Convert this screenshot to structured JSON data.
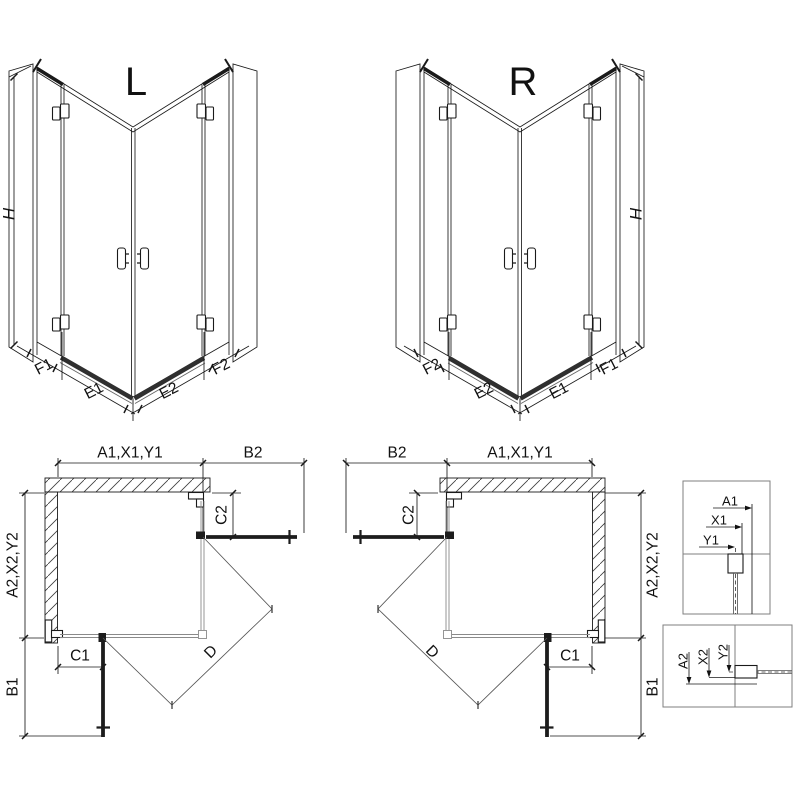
{
  "drawing": {
    "background": "#ffffff",
    "line_color": "#1a1a1a",
    "glass_color": "#8a8a8a",
    "door_color": "#1c1c1c"
  },
  "iso_left": {
    "title": "L",
    "height_dim": "H",
    "base_dims": [
      "F1",
      "E1",
      "E2",
      "F2"
    ]
  },
  "iso_right": {
    "title": "R",
    "height_dim": "H",
    "base_dims": [
      "F2",
      "E2",
      "E1",
      "F1"
    ]
  },
  "plan_left": {
    "width_dim": "A1,X1,Y1",
    "door_width_dim": "B2",
    "depth_dim": "A2,X2,Y2",
    "door_depth_dim": "B1",
    "fixed_bottom_dim": "C1",
    "fixed_side_dim": "C2",
    "entry_dim": "D"
  },
  "plan_right": {
    "width_dim": "A1,X1,Y1",
    "door_width_dim": "B2",
    "depth_dim": "A2,X2,Y2",
    "door_depth_dim": "B1",
    "fixed_bottom_dim": "C1",
    "fixed_side_dim": "C2",
    "entry_dim": "D"
  },
  "detail_width": {
    "dims": [
      "A1",
      "X1",
      "Y1"
    ]
  },
  "detail_depth": {
    "dims": [
      "A2",
      "X2",
      "Y2"
    ]
  }
}
